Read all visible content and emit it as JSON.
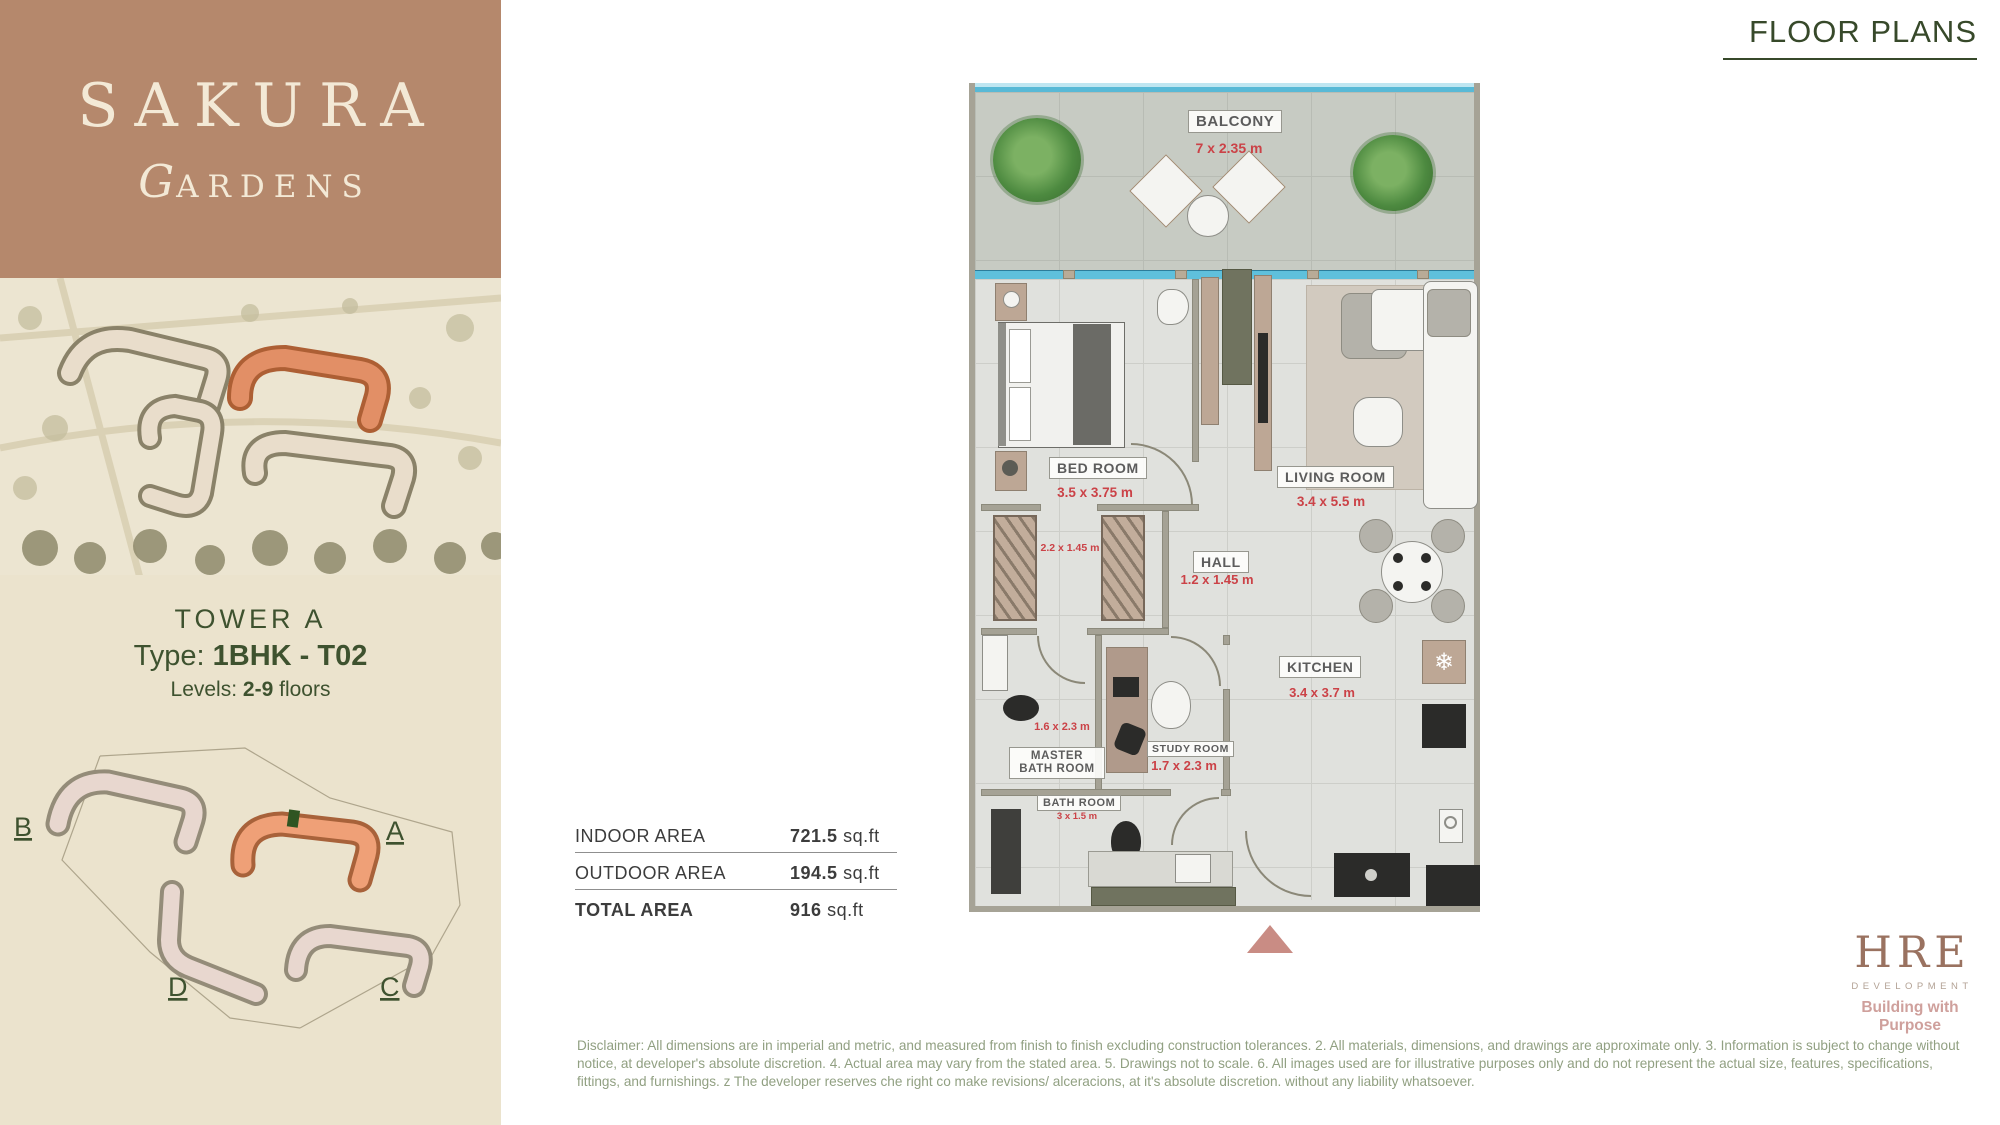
{
  "header": {
    "title": "FLOOR PLANS",
    "accent_color": "#37492a"
  },
  "brand_panel": {
    "name_line1": "SAKURA",
    "name_line2": "GARDENS",
    "bg_color": "#b5886c",
    "text_color": "#f3e9d6"
  },
  "tower_info": {
    "tower_label": "TOWER",
    "tower_value": "A",
    "type_label": "Type:",
    "type_value": "1BHK - T02",
    "levels_label": "Levels:",
    "levels_value": "2-9",
    "levels_suffix": "floors"
  },
  "site_plan": {
    "label_a": "A",
    "label_b": "B",
    "label_c": "C",
    "label_d": "D",
    "highlight_color": "#efa077",
    "unit_marker_color": "#2f5522"
  },
  "area_table": {
    "rows": [
      {
        "label": "INDOOR AREA",
        "value": "721.5",
        "unit": "sq.ft"
      },
      {
        "label": "OUTDOOR AREA",
        "value": "194.5",
        "unit": "sq.ft"
      },
      {
        "label": "TOTAL AREA",
        "value": "916",
        "unit": "sq.ft"
      }
    ]
  },
  "floor_plan": {
    "dimension_color": "#cb4247",
    "balcony": {
      "name": "BALCONY",
      "dims": "7 x 2.35 m"
    },
    "bedroom": {
      "name": "BED ROOM",
      "dims": "3.5 x 3.75 m"
    },
    "living": {
      "name": "LIVING ROOM",
      "dims": "3.4 x 5.5 m"
    },
    "hall": {
      "name": "HALL",
      "dims": "1.2 x 1.45 m"
    },
    "kitchen": {
      "name": "KITCHEN",
      "dims": "3.4 x 3.7 m"
    },
    "master_bath": {
      "name_line1": "MASTER",
      "name_line2": "BATH ROOM",
      "dims": "1.6 x 2.3 m"
    },
    "study": {
      "name": "STUDY ROOM",
      "dims": "1.7 x 2.3 m"
    },
    "bath": {
      "name": "BATH ROOM",
      "dims": "3 x 1.5 m"
    },
    "wardrobe_dims": "2.2 x 1.45 m",
    "fridge_icon": "snowflake"
  },
  "footer": {
    "disclaimer": "Disclaimer: All dimensions are in imperial and metric, and measured from finish to finish excluding construction tolerances. 2. All materials, dimensions, and drawings are approximate only. 3. Information is subject to change without notice, at developer's absolute discretion. 4. Actual area may vary from the stated area. 5. Drawings not to scale. 6. All images used are for illustrative purposes only and do not represent the actual size, features, specifications, fittings, and furnishings. z The developer reserves che right co make revisions/ alceracions, at it's absolute discretion. without any liability whatsoever."
  },
  "logo": {
    "name": "HRE",
    "sub": "DEVELOPMENT",
    "tagline": "Building with Purpose"
  }
}
